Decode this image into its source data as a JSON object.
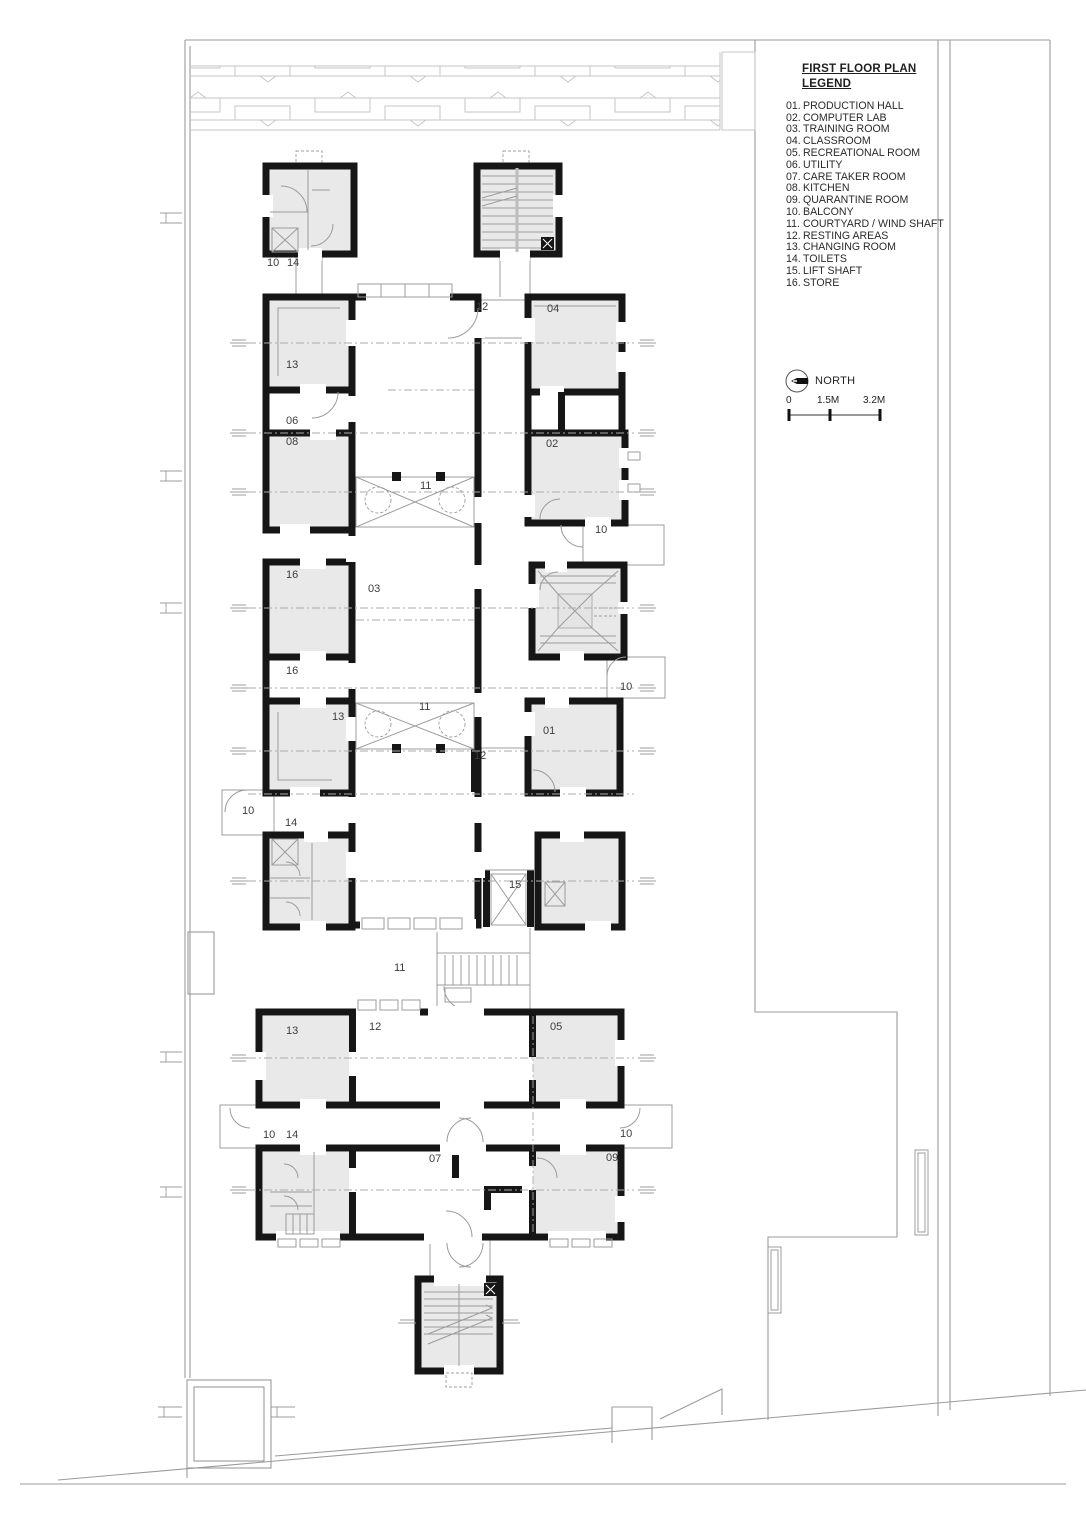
{
  "legend": {
    "title_line1": "FIRST FLOOR PLAN",
    "title_line2": "LEGEND",
    "items": [
      {
        "num": "01.",
        "label": "PRODUCTION HALL"
      },
      {
        "num": "02.",
        "label": "COMPUTER LAB"
      },
      {
        "num": "03.",
        "label": "TRAINING ROOM"
      },
      {
        "num": "04.",
        "label": "CLASSROOM"
      },
      {
        "num": "05.",
        "label": "RECREATIONAL ROOM"
      },
      {
        "num": "06.",
        "label": "UTILITY"
      },
      {
        "num": "07.",
        "label": "CARE TAKER ROOM"
      },
      {
        "num": "08.",
        "label": "KITCHEN"
      },
      {
        "num": "09.",
        "label": "QUARANTINE ROOM"
      },
      {
        "num": "10.",
        "label": "BALCONY"
      },
      {
        "num": "11.",
        "label": "COURTYARD / WIND SHAFT"
      },
      {
        "num": "12.",
        "label": "RESTING AREAS"
      },
      {
        "num": "13.",
        "label": "CHANGING ROOM"
      },
      {
        "num": "14.",
        "label": "TOILETS"
      },
      {
        "num": "15.",
        "label": "LIFT SHAFT"
      },
      {
        "num": "16.",
        "label": "STORE"
      }
    ]
  },
  "north": {
    "label": "NORTH"
  },
  "scale_bar": {
    "labels": [
      "0",
      "1.5M",
      "3.2M"
    ],
    "label_offsets": [
      0,
      31,
      77
    ],
    "tick_offsets": [
      3,
      44,
      94
    ]
  },
  "plan_labels": [
    {
      "t": "10",
      "x": 267,
      "y": 266
    },
    {
      "t": "14",
      "x": 287,
      "y": 266
    },
    {
      "t": "12",
      "x": 476,
      "y": 310
    },
    {
      "t": "04",
      "x": 547,
      "y": 312
    },
    {
      "t": "13",
      "x": 286,
      "y": 368
    },
    {
      "t": "06",
      "x": 286,
      "y": 424
    },
    {
      "t": "08",
      "x": 286,
      "y": 445
    },
    {
      "t": "11",
      "x": 420,
      "y": 489
    },
    {
      "t": "02",
      "x": 546,
      "y": 447
    },
    {
      "t": "10",
      "x": 595,
      "y": 533
    },
    {
      "t": "16",
      "x": 286,
      "y": 578
    },
    {
      "t": "03",
      "x": 368,
      "y": 592
    },
    {
      "t": "16",
      "x": 286,
      "y": 674
    },
    {
      "t": "10",
      "x": 620,
      "y": 690
    },
    {
      "t": "13",
      "x": 332,
      "y": 720
    },
    {
      "t": "11",
      "x": 419,
      "y": 710
    },
    {
      "t": "01",
      "x": 543,
      "y": 734
    },
    {
      "t": "12",
      "x": 474,
      "y": 759
    },
    {
      "t": "10",
      "x": 242,
      "y": 814
    },
    {
      "t": "14",
      "x": 285,
      "y": 826
    },
    {
      "t": "15",
      "x": 509,
      "y": 888
    },
    {
      "t": "11",
      "x": 394,
      "y": 971
    },
    {
      "t": "13",
      "x": 286,
      "y": 1034
    },
    {
      "t": "12",
      "x": 369,
      "y": 1030
    },
    {
      "t": "05",
      "x": 550,
      "y": 1030
    },
    {
      "t": "10",
      "x": 263,
      "y": 1138
    },
    {
      "t": "14",
      "x": 286,
      "y": 1138
    },
    {
      "t": "10",
      "x": 620,
      "y": 1137
    },
    {
      "t": "07",
      "x": 429,
      "y": 1162
    },
    {
      "t": "09",
      "x": 606,
      "y": 1161
    }
  ],
  "colors": {
    "wall": "#161616",
    "room_fill": "#e9e9e9",
    "thin_line": "#9c9c9c",
    "label": "#3d3d3d"
  }
}
